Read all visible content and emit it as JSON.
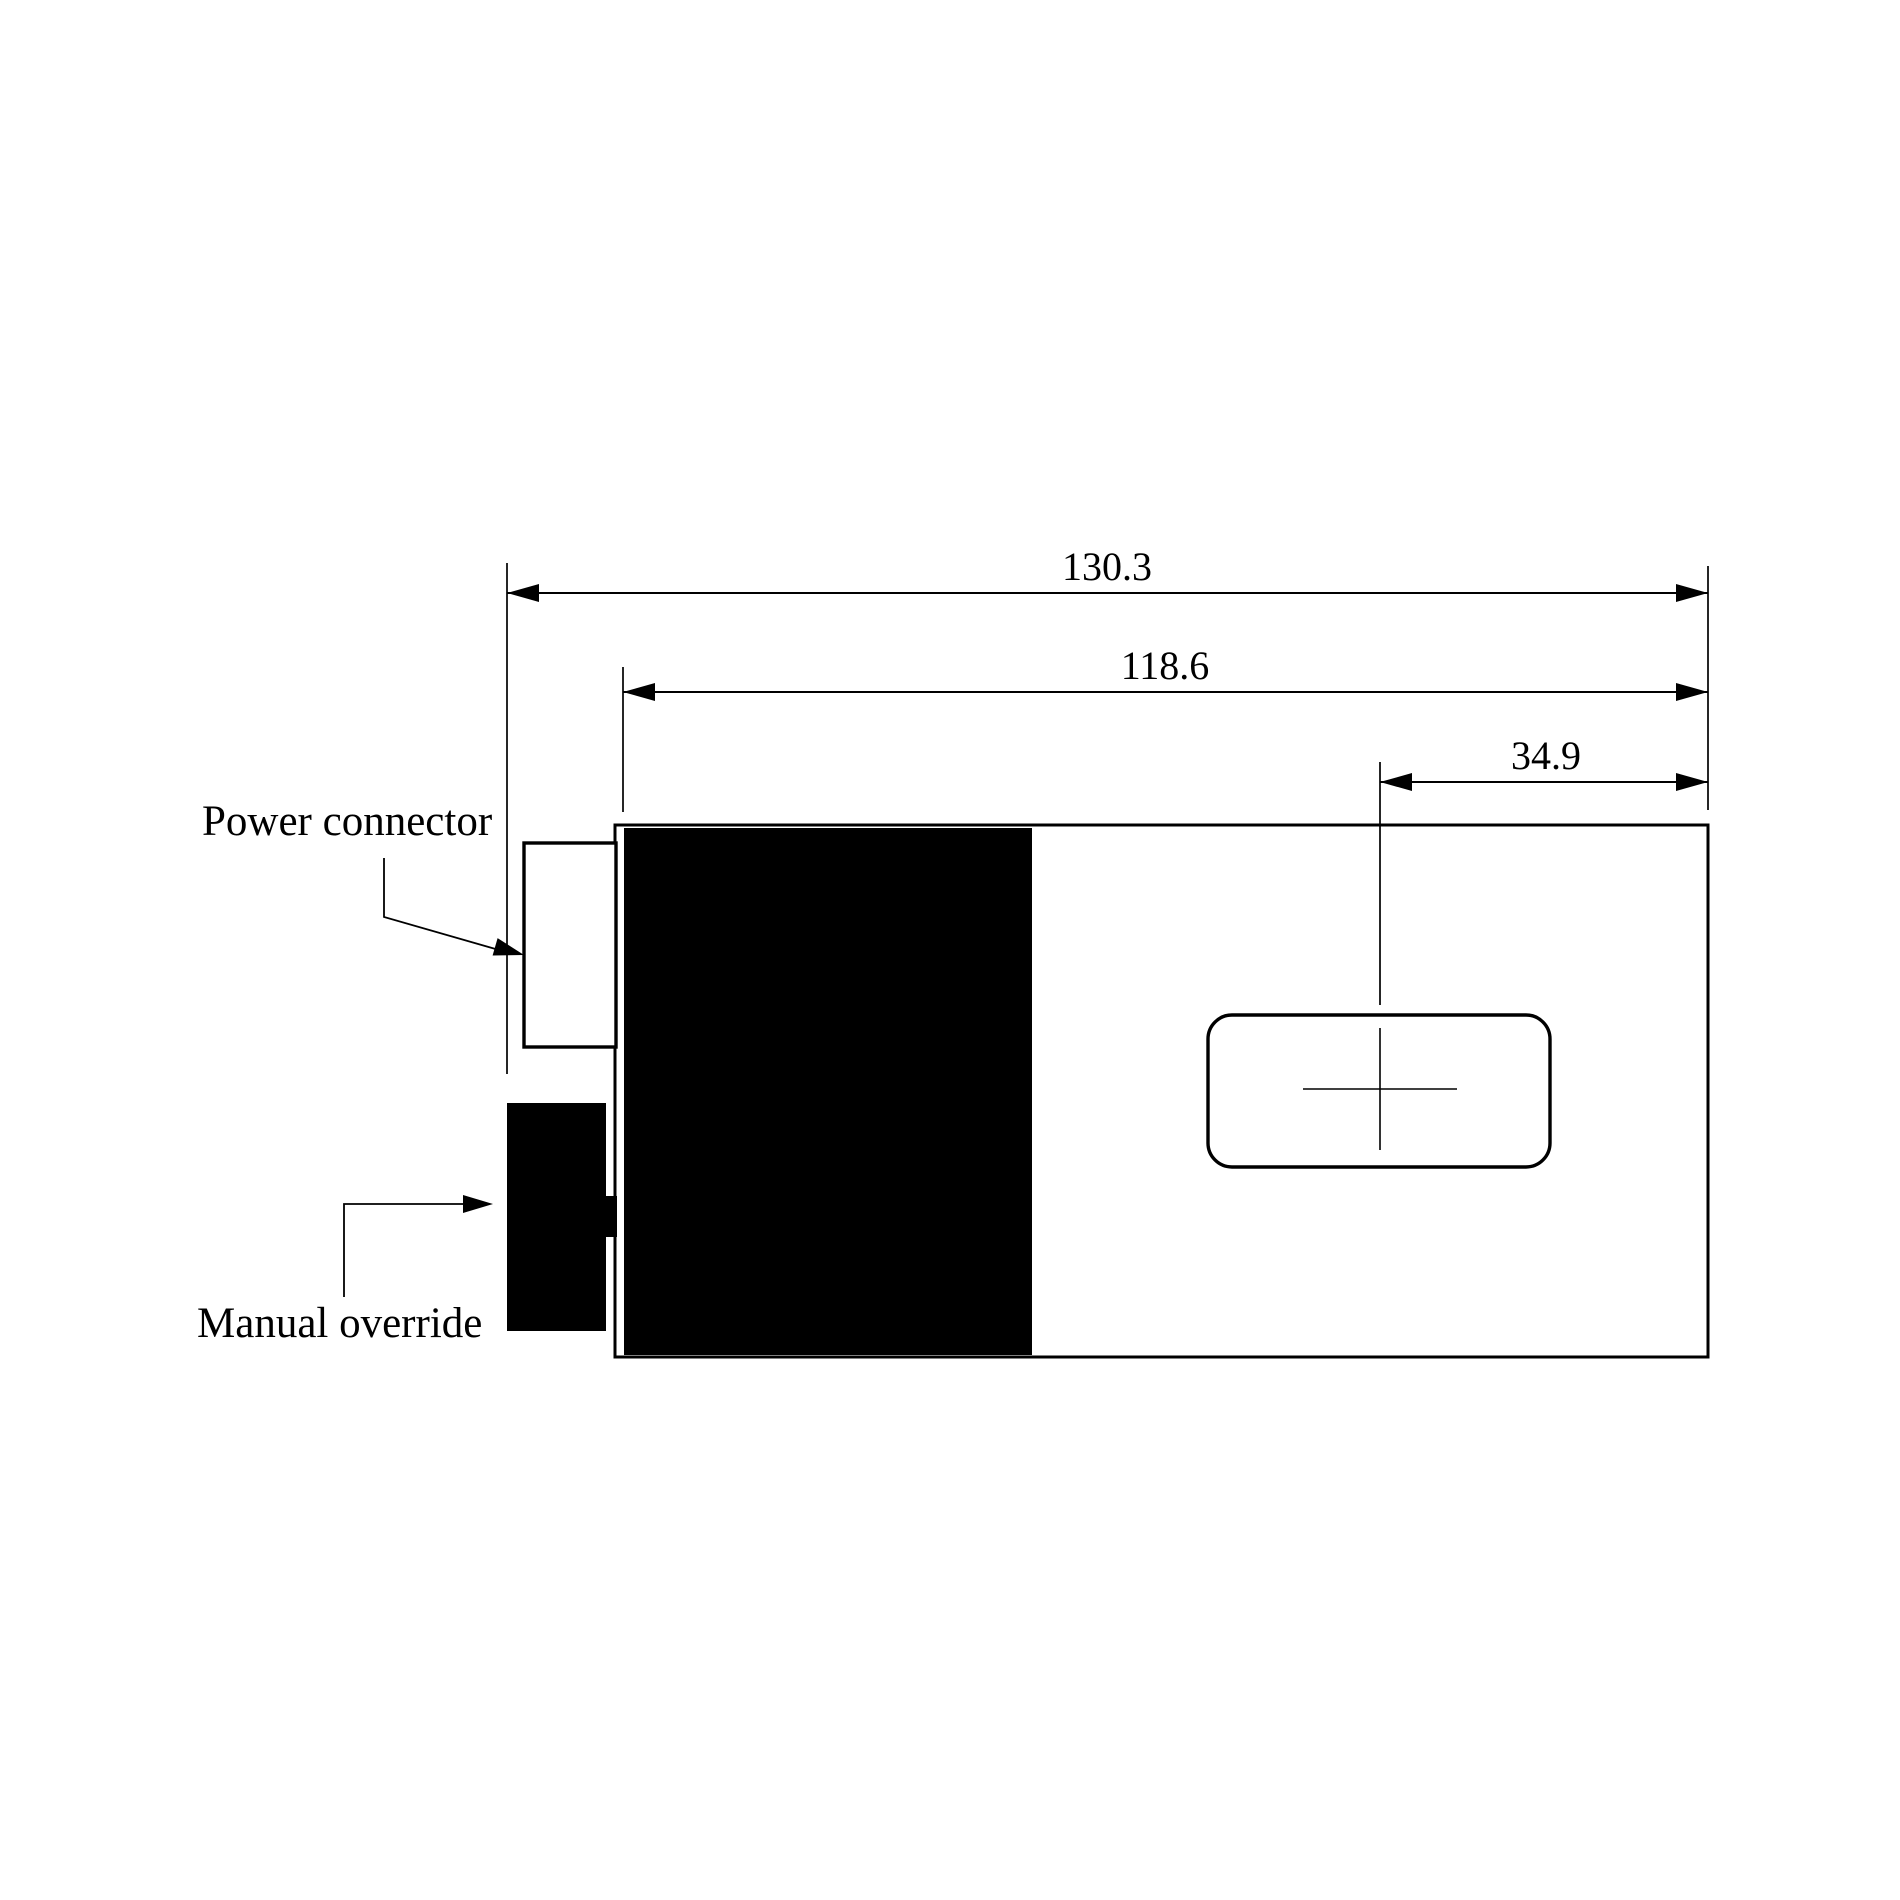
{
  "drawing": {
    "background_color": "#ffffff",
    "line_color": "#000000",
    "fill_color": "#000000",
    "dimensions": [
      {
        "id": "overall-length",
        "value": "130.3"
      },
      {
        "id": "body-length",
        "value": "118.6"
      },
      {
        "id": "slot-center-offset",
        "value": "34.9"
      }
    ],
    "callouts": [
      {
        "id": "power-connector",
        "label": "Power connector"
      },
      {
        "id": "manual-override",
        "label": "Manual override"
      }
    ]
  }
}
